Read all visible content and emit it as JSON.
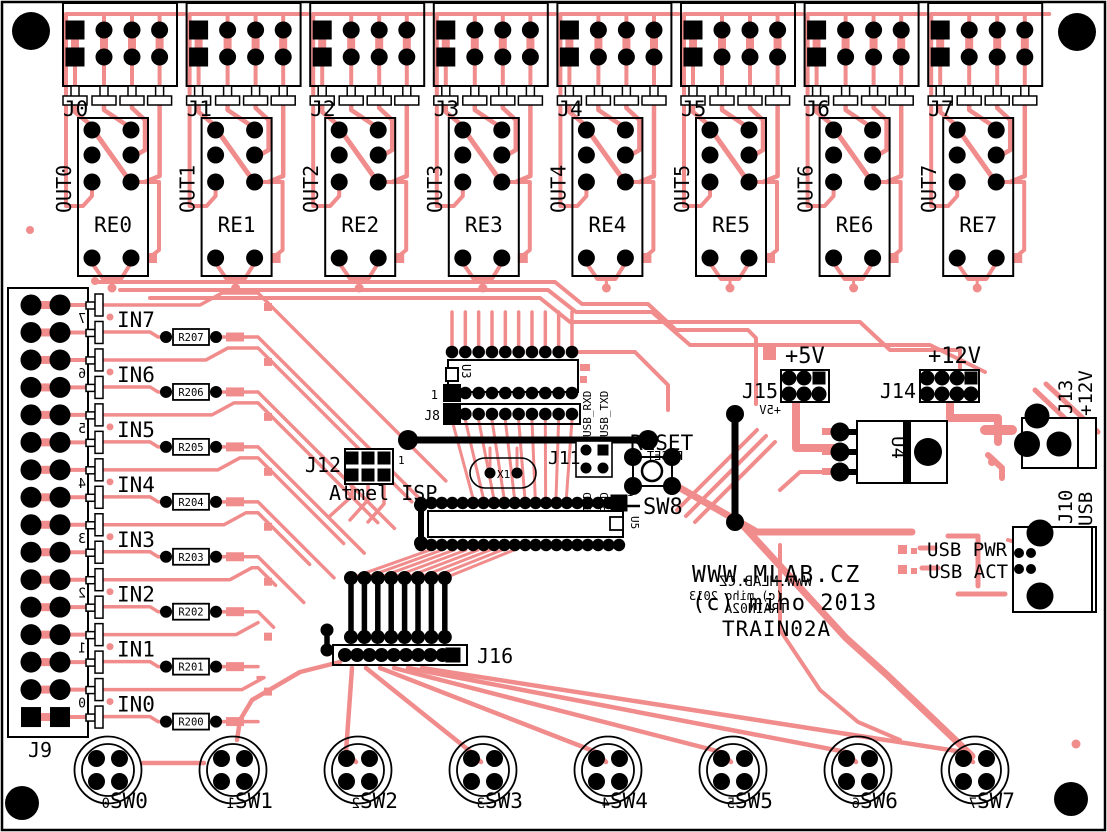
{
  "board": {
    "site": "WWW.MLAB.CZ",
    "copyright": "(c) miho 2013",
    "name": "TRAIN02A"
  },
  "board_mirror": {
    "site": "WWW.MLAB.CZ",
    "copyright": "(c) miho 2013",
    "name": "TRAIN02A"
  },
  "colors": {
    "trace": "#f18c8c",
    "silk": "#000000",
    "board": "#ffffff"
  },
  "relay_modules": [
    {
      "connector": "J0",
      "output": "OUT0",
      "relay": "RE0"
    },
    {
      "connector": "J1",
      "output": "OUT1",
      "relay": "RE1"
    },
    {
      "connector": "J2",
      "output": "OUT2",
      "relay": "RE2"
    },
    {
      "connector": "J3",
      "output": "OUT3",
      "relay": "RE3"
    },
    {
      "connector": "J4",
      "output": "OUT4",
      "relay": "RE4"
    },
    {
      "connector": "J5",
      "output": "OUT5",
      "relay": "RE5"
    },
    {
      "connector": "J6",
      "output": "OUT6",
      "relay": "RE6"
    },
    {
      "connector": "J7",
      "output": "OUT7",
      "relay": "RE7"
    }
  ],
  "input_connector": {
    "ref": "J9"
  },
  "inputs": [
    {
      "label": "IN7",
      "resistor": "R207",
      "digit": "7"
    },
    {
      "label": "IN6",
      "resistor": "R206",
      "digit": "6"
    },
    {
      "label": "IN5",
      "resistor": "R205",
      "digit": "5"
    },
    {
      "label": "IN4",
      "resistor": "R204",
      "digit": "4"
    },
    {
      "label": "IN3",
      "resistor": "R203",
      "digit": "3"
    },
    {
      "label": "IN2",
      "resistor": "R202",
      "digit": "2"
    },
    {
      "label": "IN1",
      "resistor": "R201",
      "digit": "1"
    },
    {
      "label": "IN0",
      "resistor": "R200",
      "digit": "0"
    }
  ],
  "switches": [
    {
      "label": "SW0",
      "digit": "0"
    },
    {
      "label": "SW1",
      "digit": "1"
    },
    {
      "label": "SW2",
      "digit": "2"
    },
    {
      "label": "SW3",
      "digit": "3"
    },
    {
      "label": "SW4",
      "digit": "4"
    },
    {
      "label": "SW5",
      "digit": "5"
    },
    {
      "label": "SW6",
      "digit": "6"
    },
    {
      "label": "SW7",
      "digit": "7"
    }
  ],
  "isp": {
    "ref": "J12",
    "name": "Atmel ISP",
    "pin1": "1"
  },
  "ic_u3": {
    "ref": "U3",
    "pin1": "1"
  },
  "j8": {
    "ref": "J8"
  },
  "main_ic": {
    "ref": "U5"
  },
  "serial": {
    "ref": "J11",
    "signals_top": [
      "USB_RXD",
      "USB_TXD"
    ],
    "signals_bottom": [
      "TXD",
      "RXD"
    ]
  },
  "crystal": {
    "ref": "X1"
  },
  "reset_switch": {
    "label": "RESET",
    "ref": "SW8",
    "mirror": "RESET",
    "pin1": "1"
  },
  "power5": {
    "ref": "J15",
    "label": "+5V",
    "mirror": "+5V"
  },
  "power12": {
    "ref": "J14",
    "label": "+12V"
  },
  "regulator": {
    "ref": "U4"
  },
  "dc_jack": {
    "ref": "J13",
    "label": "+12V"
  },
  "usb": {
    "ref": "J10",
    "label": "USB",
    "pwr_led": "USB PWR",
    "act_led": "USB ACT"
  },
  "aux_connector": {
    "ref": "J16"
  }
}
